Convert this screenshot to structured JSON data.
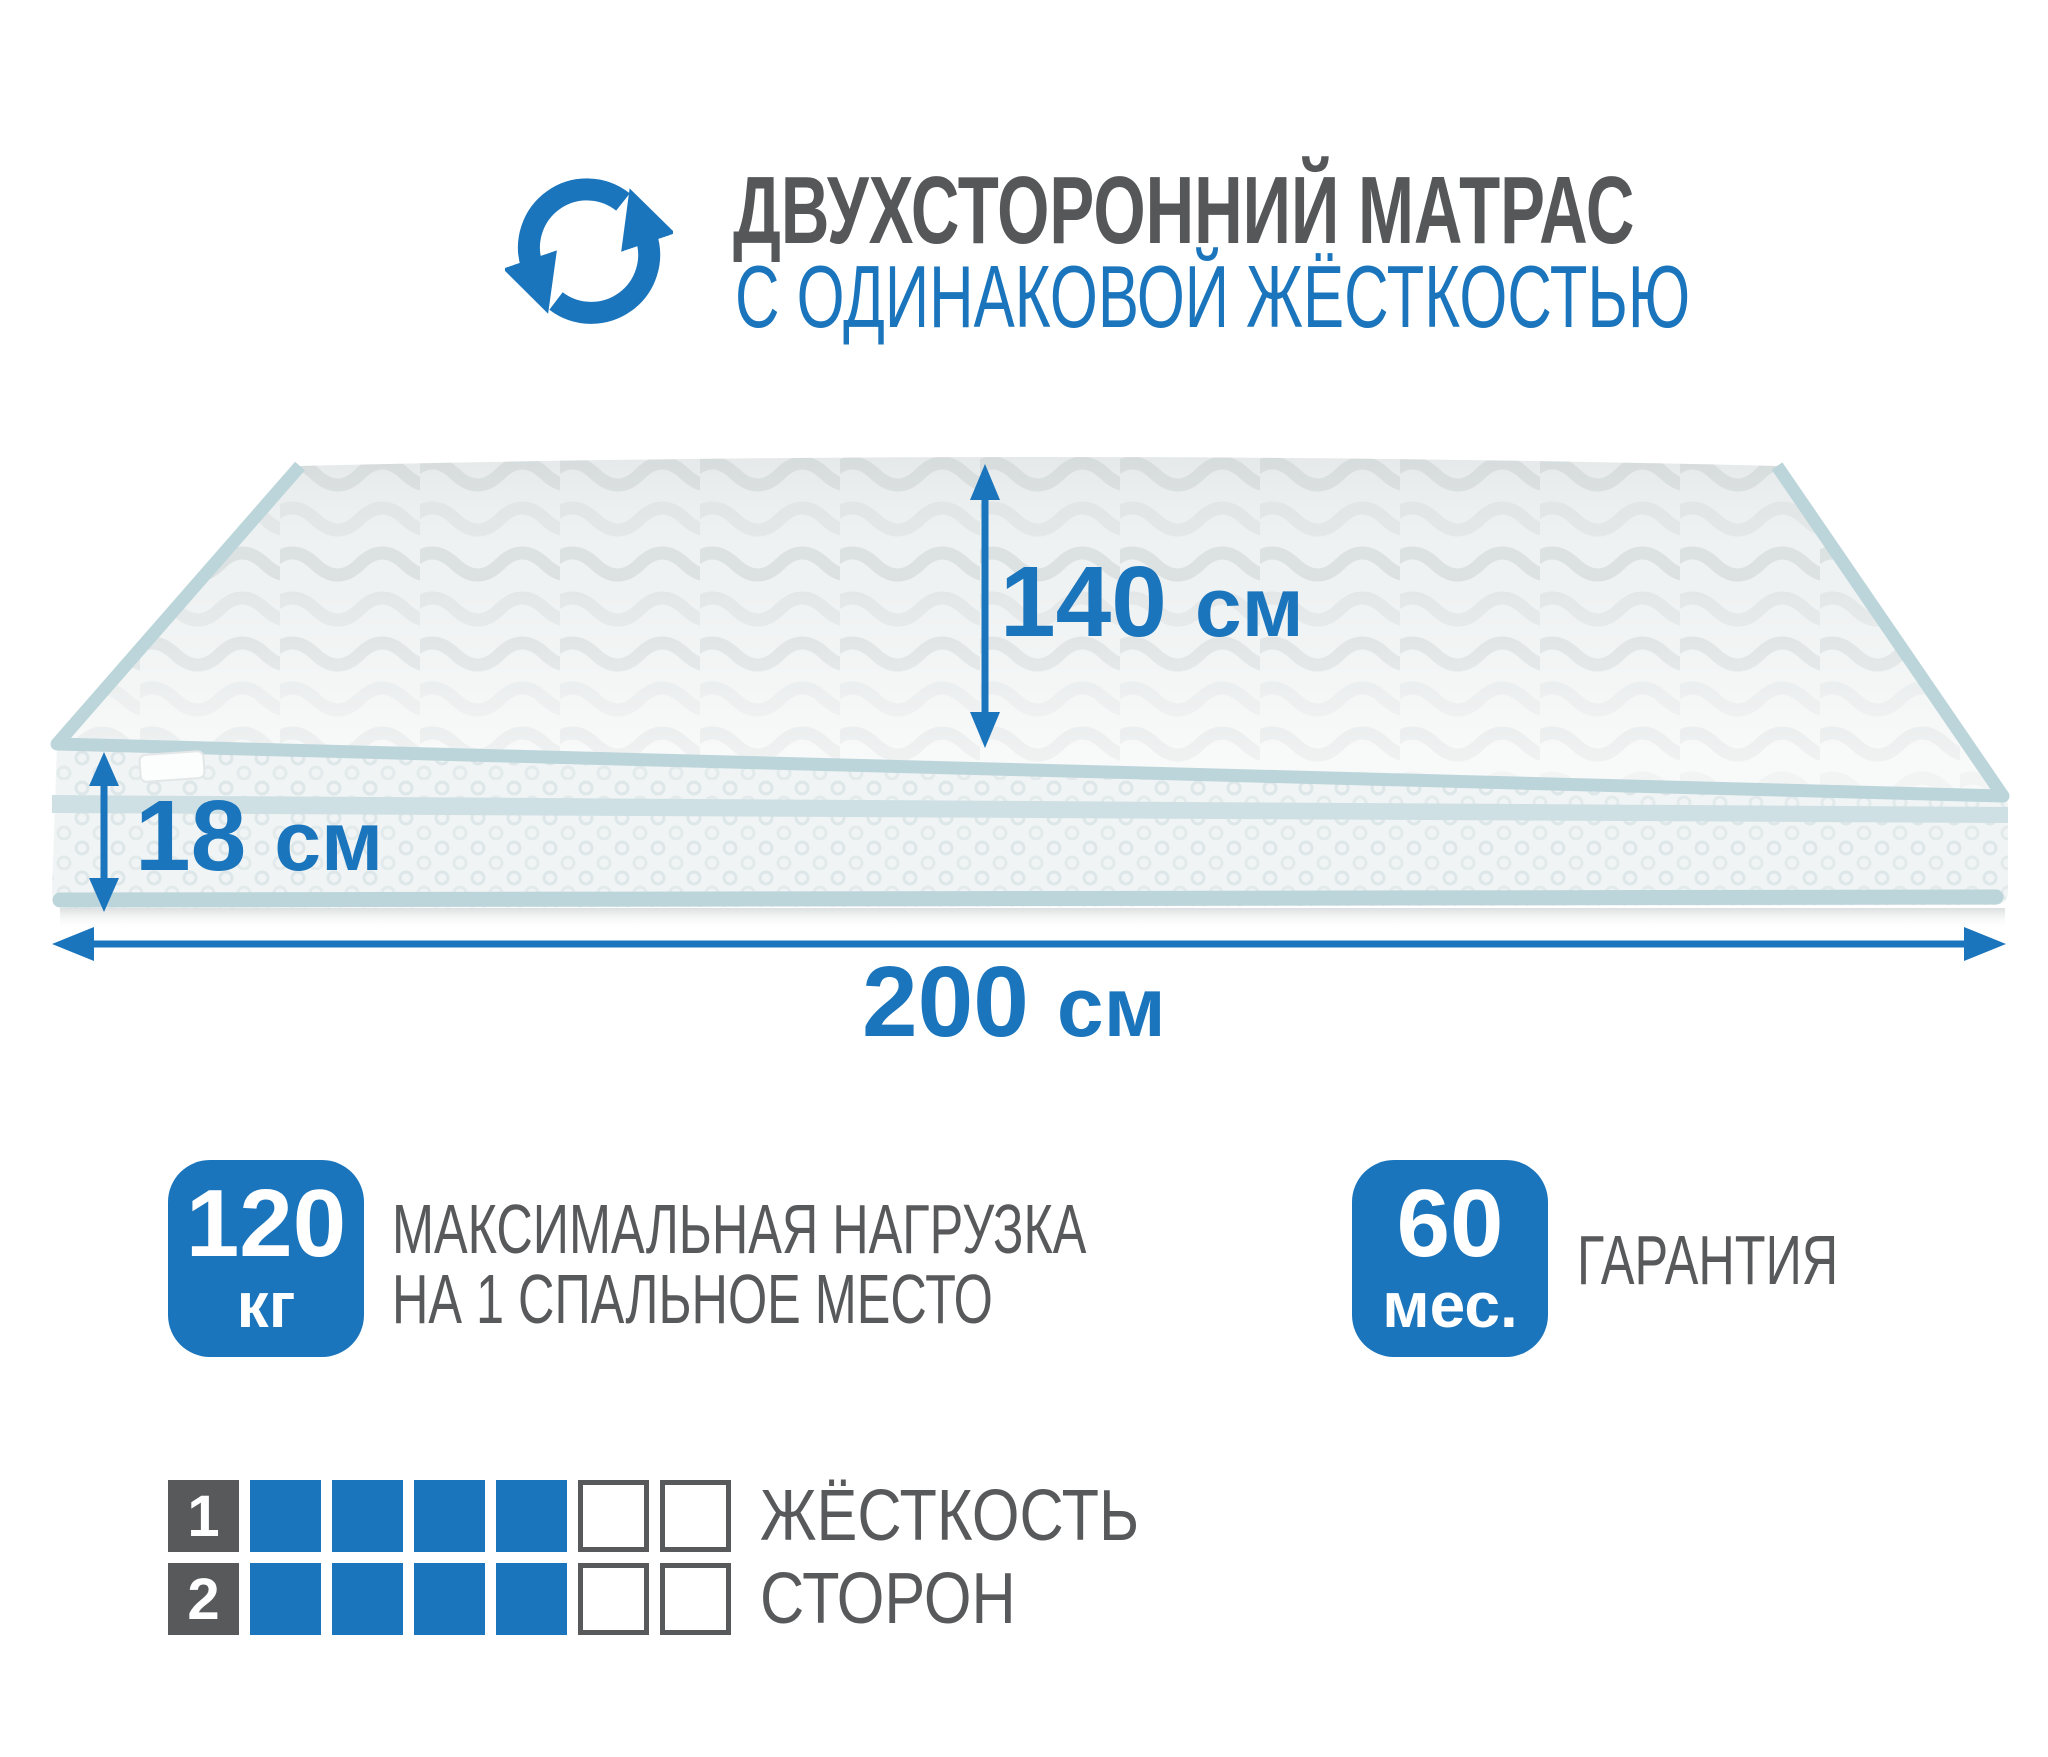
{
  "header": {
    "title": "ДВУХСТОРОННИЙ МАТРАС",
    "subtitle": "С ОДИНАКОВОЙ ЖЁСТКОСТЬЮ",
    "icon": "rotate-arrows-icon"
  },
  "dimensions": {
    "width": {
      "value": "140",
      "unit": "см"
    },
    "height": {
      "value": "18",
      "unit": "см"
    },
    "length": {
      "value": "200",
      "unit": "см"
    }
  },
  "badges": {
    "max_load": {
      "value": "120",
      "unit": "кг",
      "caption_line1": "МАКСИМАЛЬНАЯ НАГРУЗКА",
      "caption_line2": "НА 1 СПАЛЬНОЕ МЕСТО"
    },
    "warranty": {
      "value": "60",
      "unit": "мес.",
      "caption": "ГАРАНТИЯ"
    }
  },
  "firmness": {
    "label_line1": "ЖЁСТКОСТЬ",
    "label_line2": "СТОРОН",
    "scale_max": 6,
    "rows": [
      {
        "number": "1",
        "filled": 4
      },
      {
        "number": "2",
        "filled": 4
      }
    ]
  },
  "colors": {
    "accent_blue": "#1b75bc",
    "text_gray": "#58595b",
    "title_gray": "#555759",
    "piping_blue": "#bcd5da",
    "band_blue": "#cfe0e4",
    "mattress_top": "#eff2f2",
    "mattress_front": "#f1f4f4"
  }
}
